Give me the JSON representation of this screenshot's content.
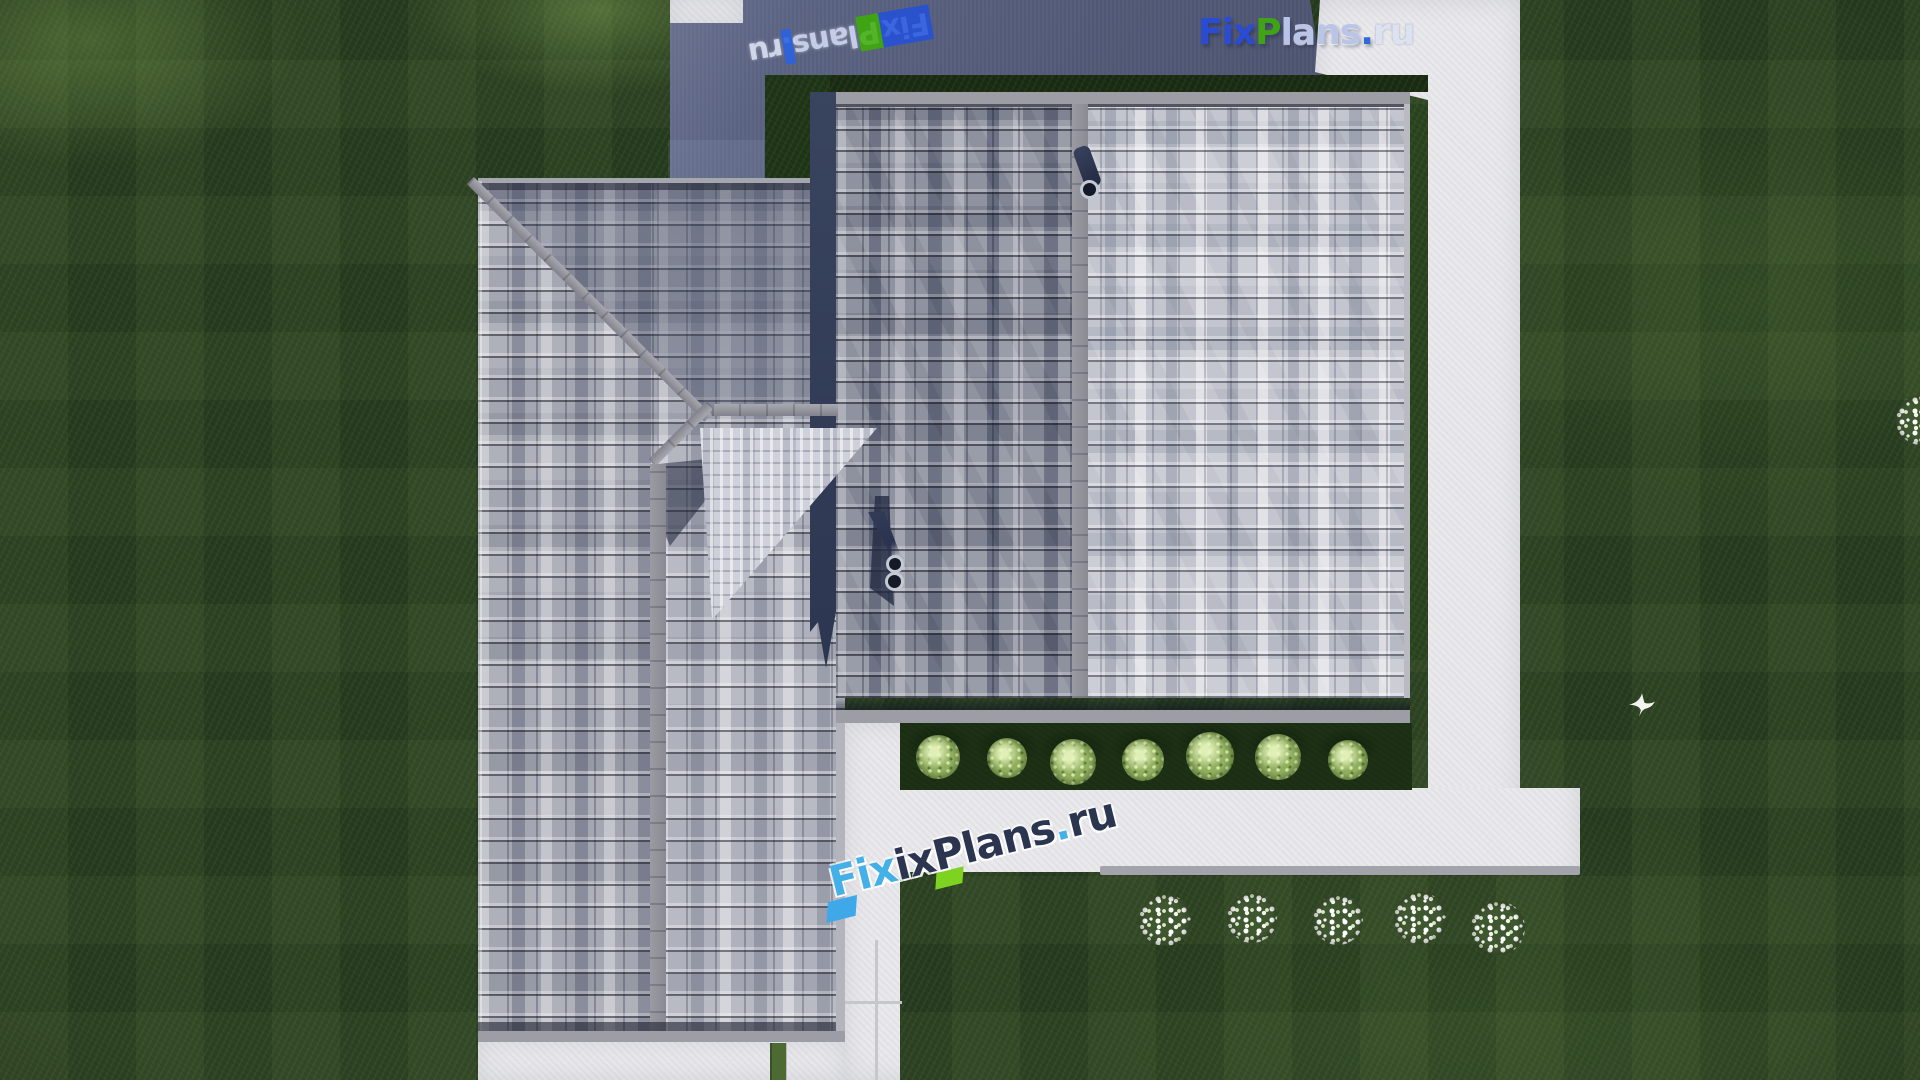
{
  "brand": {
    "full_text": "FixPlans.ru",
    "parts": {
      "fix": "Fix",
      "p": "P",
      "lans": "lans",
      "dot": ".",
      "ru": "ru"
    },
    "colors": {
      "fix_blue": "#2a4bd4",
      "p_green": "#3fa315",
      "pale_letters": "#b9c4e6",
      "dot_blue": "#2f6bd8",
      "navy_letters": "#2b3550",
      "light_blue_f": "#45b0e8",
      "green_block": "#7ed321"
    }
  },
  "scene": {
    "type": "aerial top-down 3D render of a house plan",
    "objects": {
      "left_roof_wing": "vertical tiled gable roof with north hip",
      "right_roof_wing": "large tiled gable roof, ridge vertical",
      "terrace": "slate-blue terrace at top",
      "walkways": "white concrete walkways around house",
      "hedge_bush_count": 7,
      "flower_bush_count": 6,
      "vent_pipes": 2,
      "chimney": 1,
      "bird": 1
    },
    "colors": {
      "lawn_green": "#263c1e",
      "tile_light": "#c3c6ce",
      "tile_mid": "#8f93a0",
      "ridge_gray": "#8a8a94",
      "terrace_slate": "#505875",
      "walkway_white": "#e9e9ec",
      "hedge_green": "#8fae5e",
      "shadow_navy": "#2e3850"
    }
  }
}
